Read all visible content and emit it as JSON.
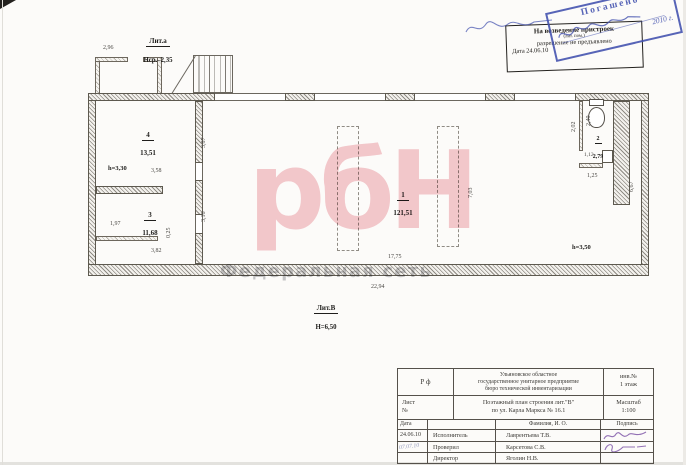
{
  "watermark": {
    "brand": "рбН",
    "subtitle": "Федеральная сеть"
  },
  "stamp_permission": {
    "line1": "На возведение пристроек",
    "line2": "(лит. пом.)",
    "line3": "разрешение не предъявлено",
    "line4": "Дата   24.06.10"
  },
  "stamp_cancelled": {
    "label": "Погашено",
    "year": "2010 г."
  },
  "plan": {
    "annex": {
      "lit": "Лит.а",
      "height": "Нср.–2,35"
    },
    "building": {
      "lit": "Лит.В",
      "height": "Н=6,50"
    },
    "rooms": {
      "r1": {
        "num": "1",
        "area": "121,51",
        "h": "h=3,50"
      },
      "r2": {
        "num": "2",
        "area": "2,79"
      },
      "r3": {
        "num": "3",
        "area": "11,68"
      },
      "r4": {
        "num": "4",
        "area": "13,51",
        "h": "h=3,30"
      }
    },
    "dims": {
      "porch": "2,96",
      "w4": "3,58",
      "d4": "3,87",
      "l3": "1,97",
      "stub": "0,25",
      "d3": "3,16",
      "w3": "3,82",
      "inner": "17,75",
      "total": "22,94",
      "d1": "7,03",
      "right": "6,67",
      "wcl": "2,02",
      "wcd": "2,40",
      "wcdoor": "1,12",
      "wcw": "1,25"
    }
  },
  "titleblock": {
    "rf": "Р  ф",
    "org1": "Ульяновское областное",
    "org2": "государственное унитарное предприятие",
    "org3": "бюро технической инвентаризации",
    "inv_label": "инв.№",
    "inv_value": "1 этаж",
    "sheet": "Лист",
    "sheet_no": "№",
    "title1": "Поэтажный план строения  лит.\"В\"",
    "title2": "по   ул. Карла Маркса № 16.1",
    "scale_label": "Масштаб",
    "scale_value": "1:100",
    "h_date": "Дата",
    "h_name": "Фамилия, И. О.",
    "h_sign": "Подпись",
    "rows": [
      {
        "date": "24.06.10",
        "role": "Исполнитель",
        "name": "Лаврентьева Т.В."
      },
      {
        "date": "07.07.10",
        "role": "Проверил",
        "name": "Карсетова С.В."
      },
      {
        "date": "",
        "role": "Директор",
        "name": "Яголин Н.В."
      }
    ]
  }
}
